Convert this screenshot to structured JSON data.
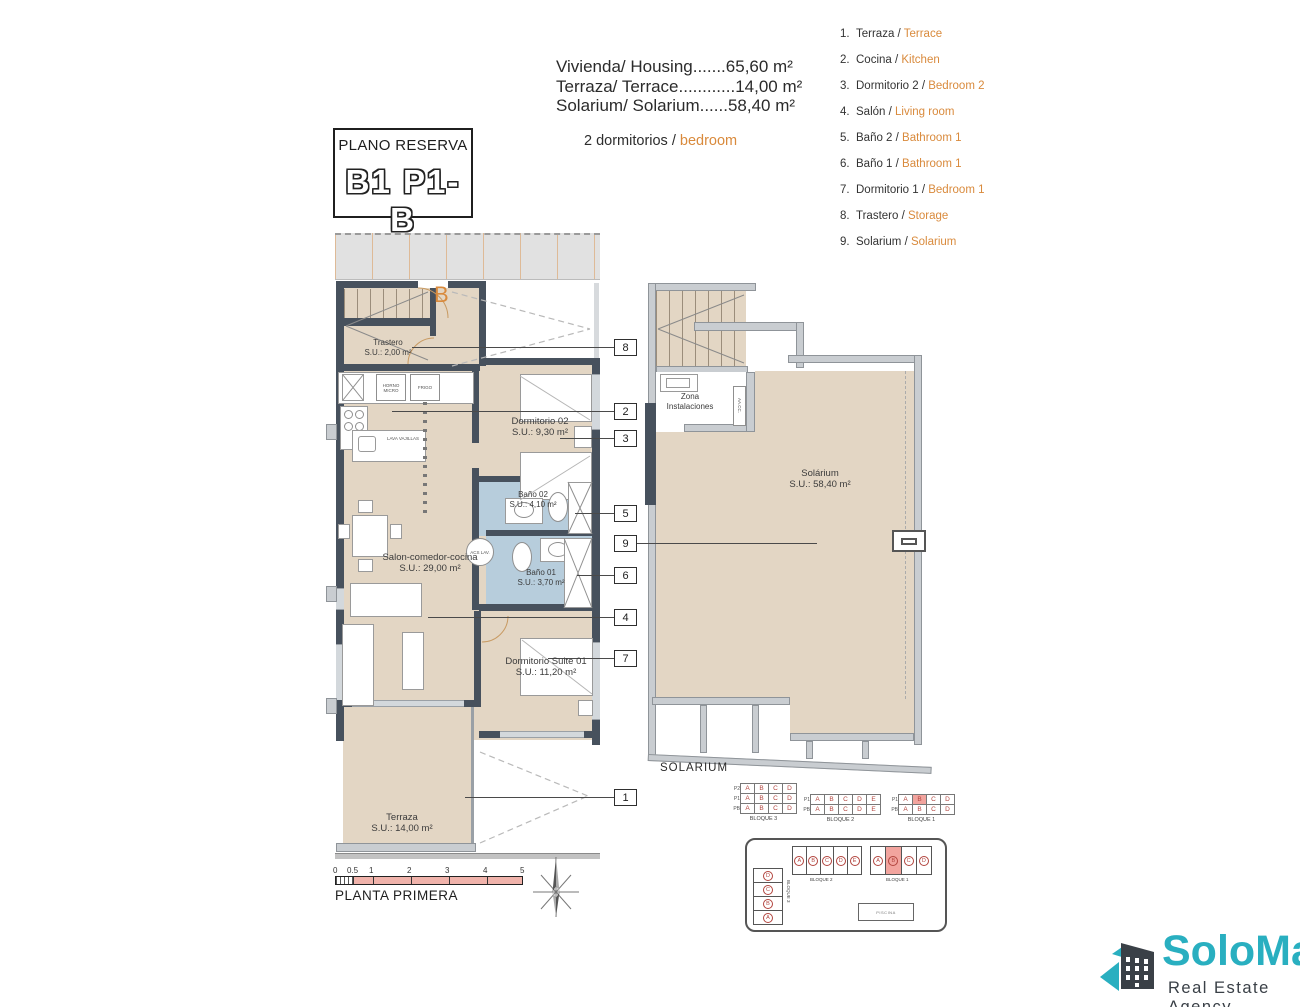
{
  "colors": {
    "accent_orange": "#D98A3C",
    "wall_dark": "#47515D",
    "floor_beige": "#E3D6C4",
    "bathroom_blue": "#B7CDDC",
    "highlight_pink": "#F2A49E",
    "keyplan_letter_red": "#B2443E",
    "scalebar_pink": "#F0B3AB",
    "logo_teal": "#29AFC0",
    "logo_dark": "#3A4047"
  },
  "areas": {
    "lines": [
      "Vivienda/ Housing.......65,60 m²",
      "Terraza/ Terrace............14,00 m²",
      "Solarium/ Solarium......58,40 m²"
    ],
    "bedrooms_es": "2 dormitorios /",
    "bedrooms_en": "bedroom"
  },
  "reserva": {
    "title": "PLANO RESERVA",
    "code": "B1 P1-B"
  },
  "legend": {
    "items": [
      {
        "num": "1.",
        "es": "Terraza /",
        "en": "Terrace"
      },
      {
        "num": "2.",
        "es": "Cocina /",
        "en": "Kitchen"
      },
      {
        "num": "3.",
        "es": "Dormitorio 2 /",
        "en": "Bedroom 2"
      },
      {
        "num": "4.",
        "es": "Salón /",
        "en": "Living room"
      },
      {
        "num": "5.",
        "es": "Baño 2 /",
        "en": "Bathroom 1"
      },
      {
        "num": "6.",
        "es": "Baño 1 /",
        "en": "Bathroom 1"
      },
      {
        "num": "7.",
        "es": "Dormitorio 1 /",
        "en": "Bedroom 1"
      },
      {
        "num": "8.",
        "es": "Trastero /",
        "en": "Storage"
      },
      {
        "num": "9.",
        "es": "Solarium /",
        "en": "Solarium"
      }
    ]
  },
  "plan": {
    "unit_letter": "B",
    "rooms": {
      "trastero": {
        "name": "Trastero",
        "area": "S.U.: 2,00 m²"
      },
      "dorm2": {
        "name": "Dormitorio 02",
        "area": "S.U.: 9,30 m²"
      },
      "bano2": {
        "name": "Baño 02",
        "area": "S.U.: 4,10 m²"
      },
      "bano1": {
        "name": "Baño 01",
        "area": "S.U.: 3,70 m²"
      },
      "salon": {
        "name": "Salon-comedor-cocina",
        "area": "S.U.: 29,00 m²"
      },
      "suite": {
        "name": "Dormitorio Suite 01",
        "area": "S.U.: 11,20 m²"
      },
      "terraza": {
        "name": "Terraza",
        "area": "S.U.: 14,00 m²"
      }
    },
    "labels": {
      "horno": "HORNO MICRO",
      "frigo": "FRIGO",
      "lava": "LAVA VAJILLAS",
      "acs": "ACS LAV."
    },
    "callouts": [
      "8",
      "2",
      "3",
      "5",
      "9",
      "6",
      "4",
      "7",
      "1"
    ]
  },
  "solarium": {
    "zona": "Zona Instalaciones",
    "aacc": "AA.CC.",
    "name": "Solárium",
    "area": "S.U.: 58,40 m²",
    "caption": "SOLARIUM"
  },
  "keyplan": {
    "blocks": [
      {
        "label": "BLOQUE 3",
        "rows": [
          {
            "level": "P2",
            "cells": [
              "A",
              "B",
              "C",
              "D"
            ]
          },
          {
            "level": "P1",
            "cells": [
              "A",
              "B",
              "C",
              "D"
            ]
          },
          {
            "level": "PB",
            "cells": [
              "A",
              "B",
              "C",
              "D"
            ]
          }
        ]
      },
      {
        "label": "BLOQUE 2",
        "rows": [
          {
            "level": "P1",
            "cells": [
              "A",
              "B",
              "C",
              "D",
              "E"
            ]
          },
          {
            "level": "PB",
            "cells": [
              "A",
              "B",
              "C",
              "D",
              "E"
            ]
          }
        ]
      },
      {
        "label": "BLOQUE 1",
        "rows": [
          {
            "level": "P1",
            "cells": [
              "A",
              "B",
              "C",
              "D"
            ],
            "highlight": "B"
          },
          {
            "level": "PB",
            "cells": [
              "A",
              "B",
              "C",
              "D"
            ]
          }
        ]
      }
    ]
  },
  "siteplan": {
    "blocks": [
      {
        "label": "BLOQUE 3",
        "letters": [
          "D",
          "C",
          "B",
          "A"
        ]
      },
      {
        "label": "BLOQUE 2",
        "letters": [
          "A",
          "B",
          "C",
          "D",
          "E"
        ]
      },
      {
        "label": "BLOQUE 1",
        "letters": [
          "A",
          "B",
          "C",
          "D"
        ],
        "highlight": "B"
      }
    ],
    "pool": "PISCINA"
  },
  "scalebar": {
    "ticks": [
      "0",
      "0.5",
      "1",
      "2",
      "3",
      "4",
      "5"
    ],
    "caption": "PLANTA PRIMERA"
  },
  "logo": {
    "name": "SoloMar",
    "tagline": "Real Estate Agency"
  }
}
